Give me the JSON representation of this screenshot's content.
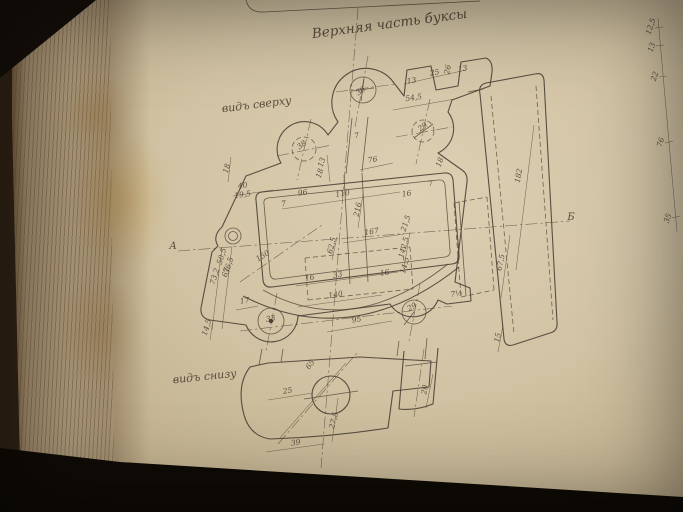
{
  "scene": {
    "background_color": "#17100a",
    "page_color": "#d0c2a2",
    "ink_color": "#4a4036",
    "stain_color": "#ba8d34"
  },
  "drawing": {
    "title": "Верхняя часть буксы",
    "view_top_label": "видъ сверху",
    "view_bottom_label": "видъ снизу",
    "section_label_left": "А",
    "section_label_right": "Б"
  },
  "dim_labels": [
    {
      "t": "13",
      "x": 412,
      "y": 83,
      "r": -9
    },
    {
      "t": "25",
      "x": 435,
      "y": 75,
      "r": -9
    },
    {
      "t": "26",
      "x": 450,
      "y": 70,
      "r": -78
    },
    {
      "t": "13",
      "x": 463,
      "y": 71,
      "r": -9
    },
    {
      "t": "54,5",
      "x": 414,
      "y": 100,
      "r": -9
    },
    {
      "t": "36",
      "x": 362,
      "y": 93,
      "r": -35
    },
    {
      "t": "29",
      "x": 424,
      "y": 129,
      "r": -35
    },
    {
      "t": "38",
      "x": 303,
      "y": 147,
      "r": -35
    },
    {
      "t": "7",
      "x": 357,
      "y": 138,
      "r": -9
    },
    {
      "t": "18",
      "x": 442,
      "y": 163,
      "r": -70
    },
    {
      "t": "7",
      "x": 431,
      "y": 186,
      "r": -9
    },
    {
      "t": "182",
      "x": 521,
      "y": 176,
      "r": -80,
      "s": 8
    },
    {
      "t": "18",
      "x": 229,
      "y": 169,
      "r": -75
    },
    {
      "t": "40",
      "x": 243,
      "y": 188,
      "r": -9
    },
    {
      "t": "19,5",
      "x": 243,
      "y": 197,
      "r": -9,
      "s": 6.5
    },
    {
      "t": "96",
      "x": 303,
      "y": 195,
      "r": -9
    },
    {
      "t": "110",
      "x": 343,
      "y": 196,
      "r": -9
    },
    {
      "t": "7",
      "x": 284,
      "y": 206,
      "r": -9
    },
    {
      "t": "13",
      "x": 324,
      "y": 163,
      "r": -72,
      "s": 6.5
    },
    {
      "t": "18",
      "x": 322,
      "y": 174,
      "r": -72,
      "s": 6.5
    },
    {
      "t": "76",
      "x": 373,
      "y": 162,
      "r": -9
    },
    {
      "t": "216",
      "x": 360,
      "y": 210,
      "r": -78,
      "s": 7
    },
    {
      "t": "16",
      "x": 407,
      "y": 196,
      "r": -9
    },
    {
      "t": "21,5",
      "x": 408,
      "y": 224,
      "r": -72,
      "s": 6.5
    },
    {
      "t": "167",
      "x": 372,
      "y": 234,
      "r": -9
    },
    {
      "t": "142,5",
      "x": 406,
      "y": 248,
      "r": -75,
      "s": 6.5
    },
    {
      "t": "14,5",
      "x": 407,
      "y": 266,
      "r": -75,
      "s": 6.5
    },
    {
      "t": "62,5",
      "x": 334,
      "y": 246,
      "r": -75,
      "s": 6.5
    },
    {
      "t": "33",
      "x": 338,
      "y": 277,
      "r": -9
    },
    {
      "t": "16",
      "x": 310,
      "y": 280,
      "r": -9
    },
    {
      "t": "16",
      "x": 385,
      "y": 275,
      "r": -9
    },
    {
      "t": "140",
      "x": 336,
      "y": 297,
      "r": -9
    },
    {
      "t": "95",
      "x": 357,
      "y": 322,
      "r": -9
    },
    {
      "t": "17",
      "x": 245,
      "y": 303,
      "r": -9
    },
    {
      "t": "33",
      "x": 271,
      "y": 321,
      "r": -9
    },
    {
      "t": "29",
      "x": 413,
      "y": 309,
      "r": -30
    },
    {
      "t": "7½",
      "x": 457,
      "y": 296,
      "r": -9
    },
    {
      "t": "14,5",
      "x": 209,
      "y": 328,
      "r": -73,
      "s": 6.5
    },
    {
      "t": "73,2",
      "x": 217,
      "y": 277,
      "r": -73,
      "s": 6.5
    },
    {
      "t": "67",
      "x": 228,
      "y": 273,
      "r": -73
    },
    {
      "t": "50,5",
      "x": 224,
      "y": 257,
      "r": -73,
      "s": 6
    },
    {
      "t": "36,5",
      "x": 231,
      "y": 266,
      "r": -73,
      "s": 6
    },
    {
      "t": "150",
      "x": 264,
      "y": 258,
      "r": -32
    },
    {
      "t": "65",
      "x": 312,
      "y": 366,
      "r": -52
    },
    {
      "t": "25",
      "x": 288,
      "y": 393,
      "r": -10
    },
    {
      "t": "27,5",
      "x": 336,
      "y": 421,
      "r": -75,
      "s": 6.5
    },
    {
      "t": "39",
      "x": 296,
      "y": 445,
      "r": -8
    },
    {
      "t": "20",
      "x": 427,
      "y": 390,
      "r": -80
    },
    {
      "t": "67,5",
      "x": 503,
      "y": 263,
      "r": -78
    },
    {
      "t": "15",
      "x": 500,
      "y": 338,
      "r": -78
    },
    {
      "t": "12,5",
      "x": 653,
      "y": 27,
      "r": -72,
      "s": 6
    },
    {
      "t": "13",
      "x": 654,
      "y": 48,
      "r": -72,
      "s": 6
    },
    {
      "t": "22",
      "x": 657,
      "y": 77,
      "r": -72,
      "s": 6
    },
    {
      "t": "76",
      "x": 663,
      "y": 143,
      "r": -72,
      "s": 6
    },
    {
      "t": "35",
      "x": 670,
      "y": 219,
      "r": -72,
      "s": 6
    }
  ]
}
